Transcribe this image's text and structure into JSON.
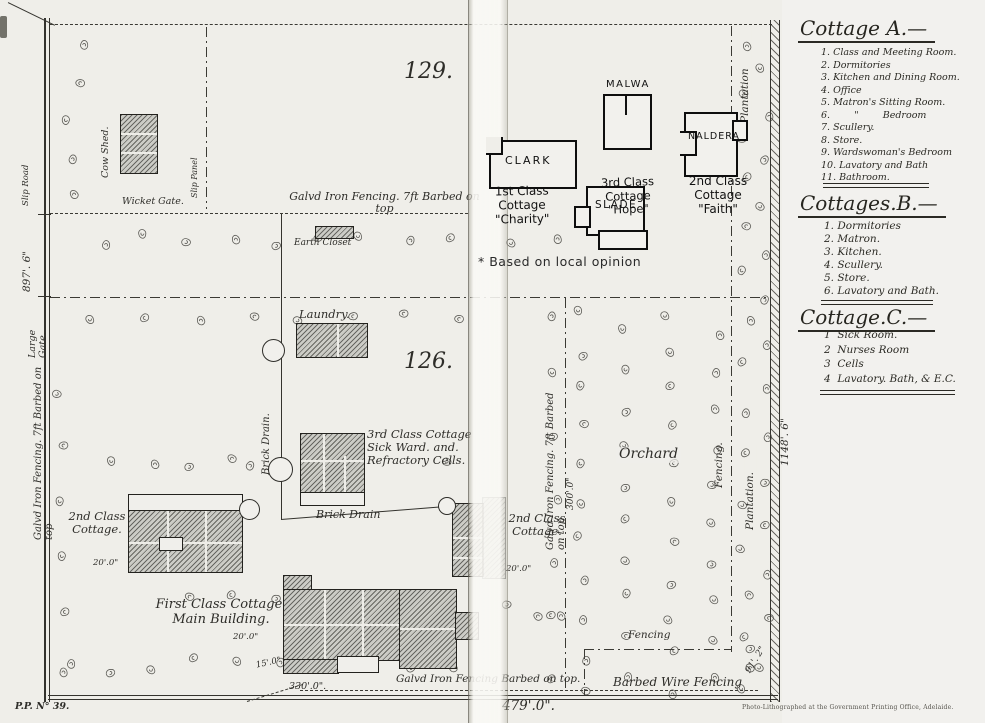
{
  "legend": {
    "cottage_a": {
      "title": "Cottage A.—",
      "items": [
        "1. Class and Meeting Room.",
        "2. Dormitories",
        "3. Kitchen and Dining Room.",
        "4. Office",
        "5. Matron's Sitting Room.",
        "6.        \"        Bedroom",
        "7. Scullery.",
        "8. Store.",
        "9. Wardswoman's Bedroom",
        "10. Lavatory and Bath",
        "11. Bathroom."
      ]
    },
    "cottages_b": {
      "title": "Cottages.B.—",
      "items": [
        "1. Dormitories",
        "2. Matron.",
        "3. Kitchen.",
        "4. Scullery.",
        "5. Store.",
        "6. Lavatory and Bath."
      ]
    },
    "cottage_c": {
      "title": "Cottage.C.—",
      "items": [
        "1  Sick Room.",
        "2  Nurses Room",
        "3  Cells",
        "4  Lavatory. Bath, & E.C."
      ]
    }
  },
  "plan": {
    "field_numbers": {
      "upper": "129.",
      "lower": "126."
    },
    "buildings": {
      "cow_shed": "Cow Shed.",
      "earth_closet": "Earth Closet",
      "laundry": "Laundry.",
      "sick_ward": "3rd Class Cottage\nSick Ward. and.\nRefractory Cells.",
      "second_class_left": "2nd Class\nCottage.",
      "second_class_right": "2nd Class\nCottage.",
      "first_class": "First Class Cottage.\nMain Building."
    },
    "hand_annotations": {
      "malwa": "MALWA",
      "clark": "CLARK",
      "slade": "SLADE",
      "naldera": "NALDERA",
      "hope": "3rd Class\nCottage\n\"Hope\"",
      "charity": "1st Class Cottage\n\"Charity\"",
      "faith": "2nd Class\nCottage\n\"Faith\"",
      "note": "* Based on local opinion"
    },
    "fences": {
      "top": "Galvd Iron Fencing. 7ft Barbed on top",
      "left": "Galvd Iron Fencing. 7ft Barbed on top",
      "middle": "Galvd Iron Fencing. 7ft Barbed on top",
      "bottom": "Galvd Iron Fencing Barbed on top.",
      "barbed_wire": "Barbed Wire Fencing",
      "fencing_v": "Fencing.",
      "fencing_h": "Fencing"
    },
    "features": {
      "slip_road": "Slip Road",
      "slip_panel": "Slip Panel",
      "wicket_gate": "Wicket Gate.",
      "large_gate": "Large Gate.",
      "brick_drain_v": "Brick Drain.",
      "brick_drain_h": "Brick Drain",
      "orchard": "Orchard",
      "plantation_top": "Plantation",
      "plantation_right": "Plantation."
    },
    "dimensions": {
      "west": "897'. 6\"",
      "east": "1148'. 6\"",
      "south_inner": "330'.0\".",
      "south": "479'.0\".",
      "middle": "300'.0\"",
      "southeast": "91'. 2\"",
      "cottage_left": "20'.0\"",
      "cottage_right": "20'.0\"",
      "main_w": "20'.0\"",
      "main_s": "15'.0\""
    }
  },
  "footer": {
    "plate": "P.P. N° 39.",
    "attribution": "Photo-Lithographed at the Government Printing Office, Adelaide."
  }
}
